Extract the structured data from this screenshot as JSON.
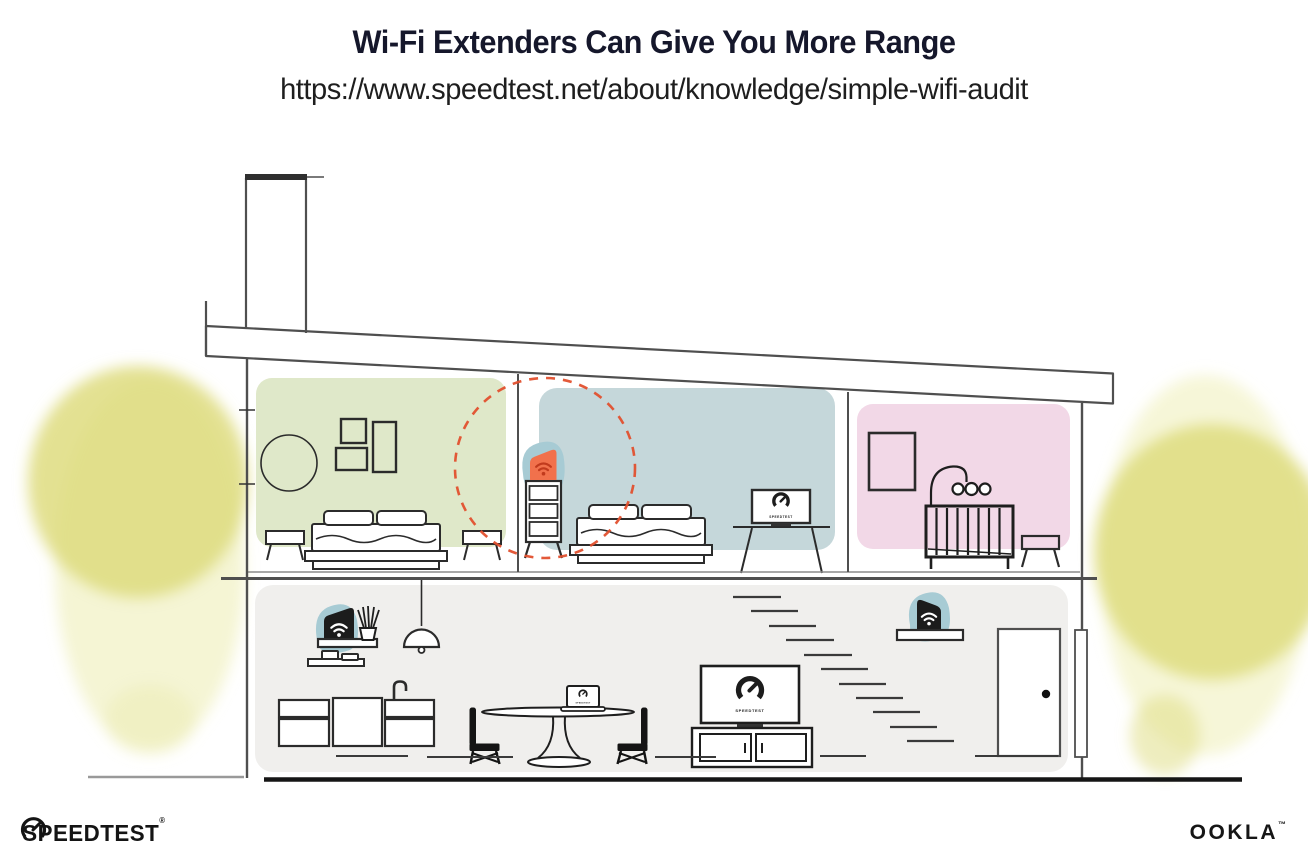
{
  "header": {
    "title": "Wi-Fi Extenders Can Give You More Range",
    "url": "https://www.speedtest.net/about/knowledge/simple-wifi-audit"
  },
  "footer": {
    "speedtest": {
      "text": "SPEEDTEST",
      "mark": "®"
    },
    "ookla": {
      "text": "OOKLA",
      "mark": "™"
    }
  },
  "illustration": {
    "screen_label": "SPEEDTEST",
    "colors": {
      "room_green": "#dfe8c9",
      "room_blue": "#c5d7da",
      "room_pink": "#f2d8e7",
      "lower_floor": "#f0efed",
      "extender_teal": "#a7cbd4",
      "extender_orange": "#f1714c",
      "wifi_on_orange": "#c13a1d",
      "wifi_on_dark": "#ffffff",
      "range_circle": "#e1502e",
      "device_dark": "#1c1c1c",
      "foliage": "#dedc7f",
      "foliage_light": "#eceba9",
      "ink": "#15172b"
    }
  }
}
